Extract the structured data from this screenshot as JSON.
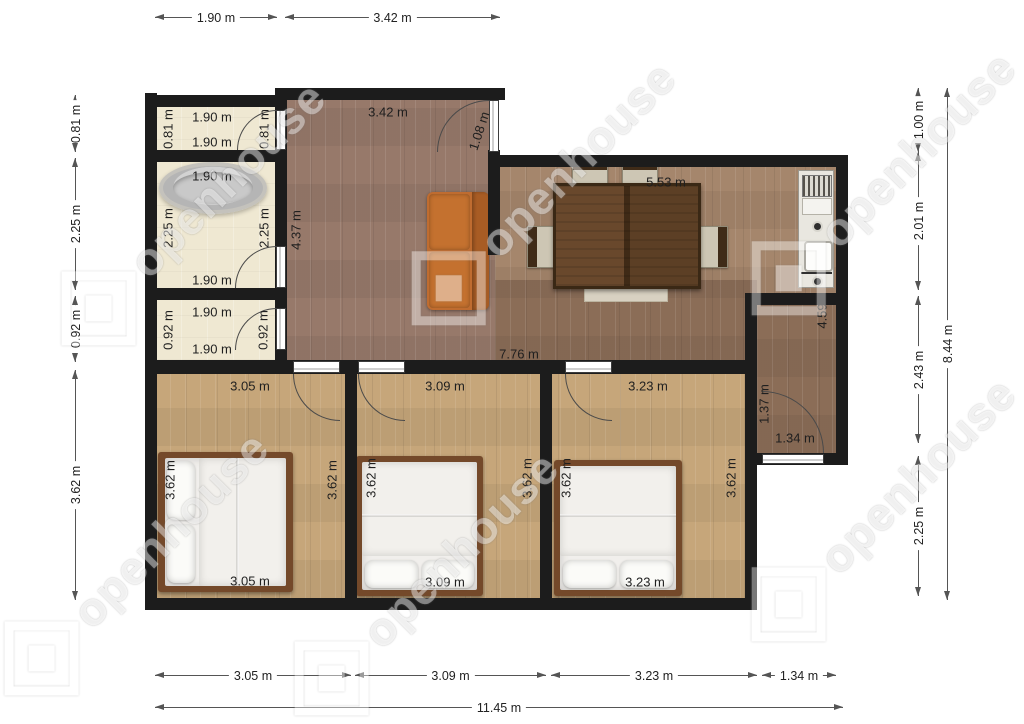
{
  "watermark": {
    "brand": "openhouse"
  },
  "units": "m",
  "colors": {
    "wall": "#1c1c1c",
    "floor_cream": "#efe8d2",
    "floor_hall": "#97796a",
    "floor_living": "#a5866c",
    "floor_corridor": "#8b6d57",
    "floor_bedroom": "#c6a67a",
    "sofa": "#bf6c30",
    "table": "#5d3e23",
    "bed_frame": "#74492a",
    "mattress": "#f1efec",
    "tub": "#b5b5b5",
    "counter": "#e9e7e0"
  },
  "dimensions": {
    "top": [
      "1.90 m",
      "3.42 m"
    ],
    "left": [
      "0.81 m",
      "2.25 m",
      "0.92 m",
      "3.62 m"
    ],
    "right": [
      "1.00 m",
      "2.01 m",
      "2.43 m",
      "2.25 m"
    ],
    "right_total": "8.44 m",
    "bottom": [
      "3.05 m",
      "3.09 m",
      "3.23 m",
      "1.34 m"
    ],
    "bottom_total": "11.45 m"
  },
  "rooms": {
    "wc_top": {
      "w_top": "1.90 m",
      "w_bottom": "1.90 m",
      "h_left": "0.81 m",
      "h_right": "0.81 m"
    },
    "bathroom": {
      "w_top": "1.90 m",
      "w_bottom": "1.90 m",
      "h_left": "2.25 m",
      "h_right": "2.25 m"
    },
    "wc_bottom": {
      "w_top": "1.90 m",
      "w_bottom": "1.90 m",
      "h_left": "0.92 m",
      "h_right": "0.92 m"
    },
    "hall": {
      "w_top": "3.42 m",
      "h_left": "4.37 m",
      "door": "1.08 m"
    },
    "living_dining": {
      "w_top": "5.53 m"
    },
    "hallway": {
      "length": "7.76 m"
    },
    "entry": {
      "h_side": "4.59",
      "door_h": "1.37 m",
      "w_bottom": "1.34 m"
    },
    "bedroom_left": {
      "w_top": "3.05 m",
      "w_bottom": "3.05 m",
      "h_left": "3.62 m",
      "h_right": "3.62 m"
    },
    "bedroom_middle": {
      "w_top": "3.09 m",
      "w_bottom": "3.09 m",
      "h_left": "3.62 m",
      "h_right": "3.62 m"
    },
    "bedroom_right": {
      "w_top": "3.23 m",
      "w_bottom": "3.23 m",
      "h_left": "3.62 m",
      "h_right": "3.62 m"
    }
  }
}
